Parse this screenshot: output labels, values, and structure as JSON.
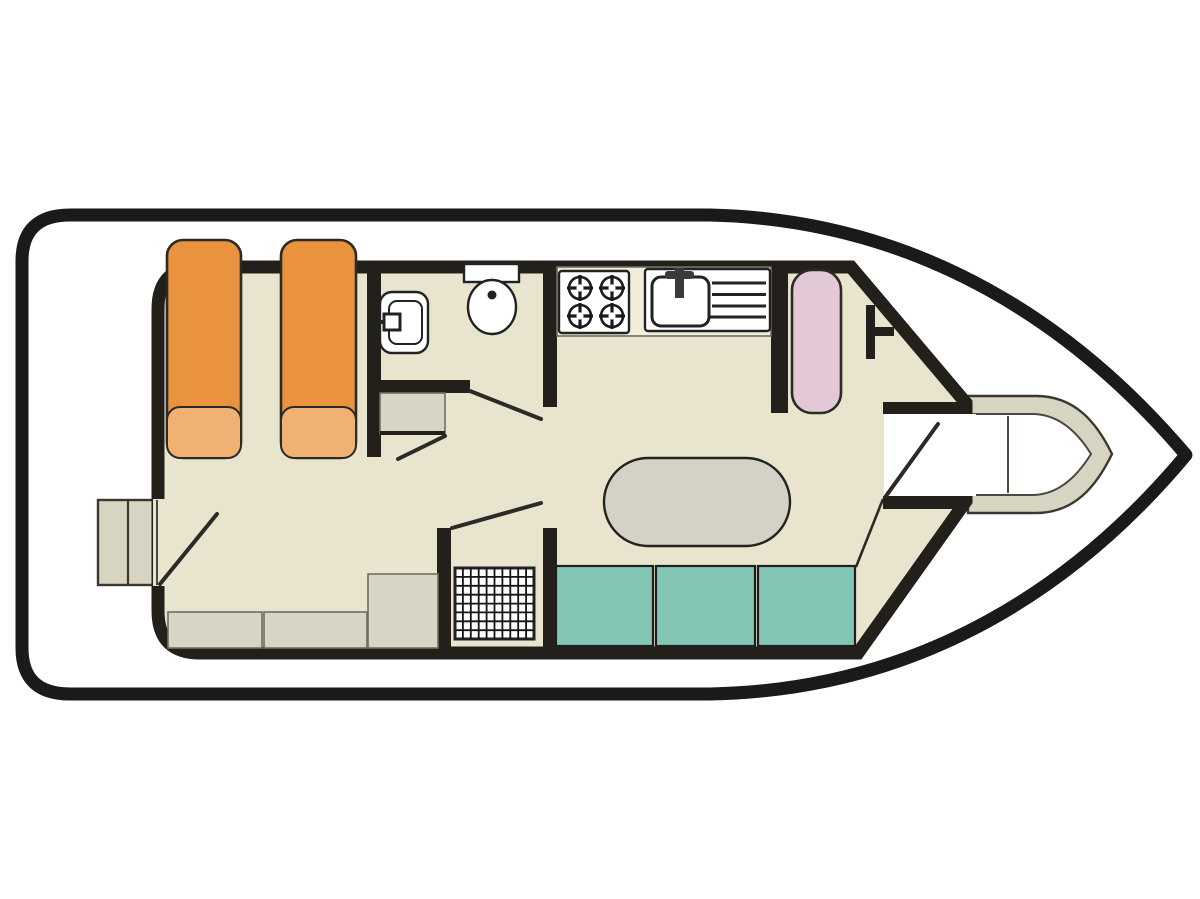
{
  "diagram": {
    "type": "boat-floor-plan",
    "subject": "houseboat deck layout, side-view hull pointing right (bow right, stern left)"
  },
  "colors": {
    "background": "#ffffff",
    "hull_outline": "#1a1a18",
    "wall": "#23201b",
    "floor": "#e8e4cd",
    "counter": "#f0eddb",
    "furniture_grey": "#d8d5c4",
    "table_grey": "#d4d1c6",
    "platform_grey": "#d7d4c2",
    "bed_orange": "#e9933e",
    "pillow_orange": "#f0b173",
    "berth_pink": "#e2c9d5",
    "seat_teal": "#84c6b5",
    "fixture_white": "#ffffff"
  },
  "icons": [
    "single-berth-icon",
    "pillow-icon",
    "washbasin-icon",
    "toilet-icon",
    "four-burner-stove-icon",
    "galley-sink-with-drainer-icon",
    "faucet-icon",
    "side-berth-icon",
    "helm-icon",
    "dinette-table-icon",
    "seat-cushion-icon",
    "shower-grate-icon",
    "wardrobe-icon",
    "bench-icon",
    "swim-step-icon",
    "bow-steps-icon",
    "door-swing-icon"
  ],
  "inventory": {
    "single_berths": 2,
    "side_berths": 1,
    "dinette_seats": 3,
    "stove_burners": 4,
    "stern_benches": 3,
    "door_openings": 6
  }
}
